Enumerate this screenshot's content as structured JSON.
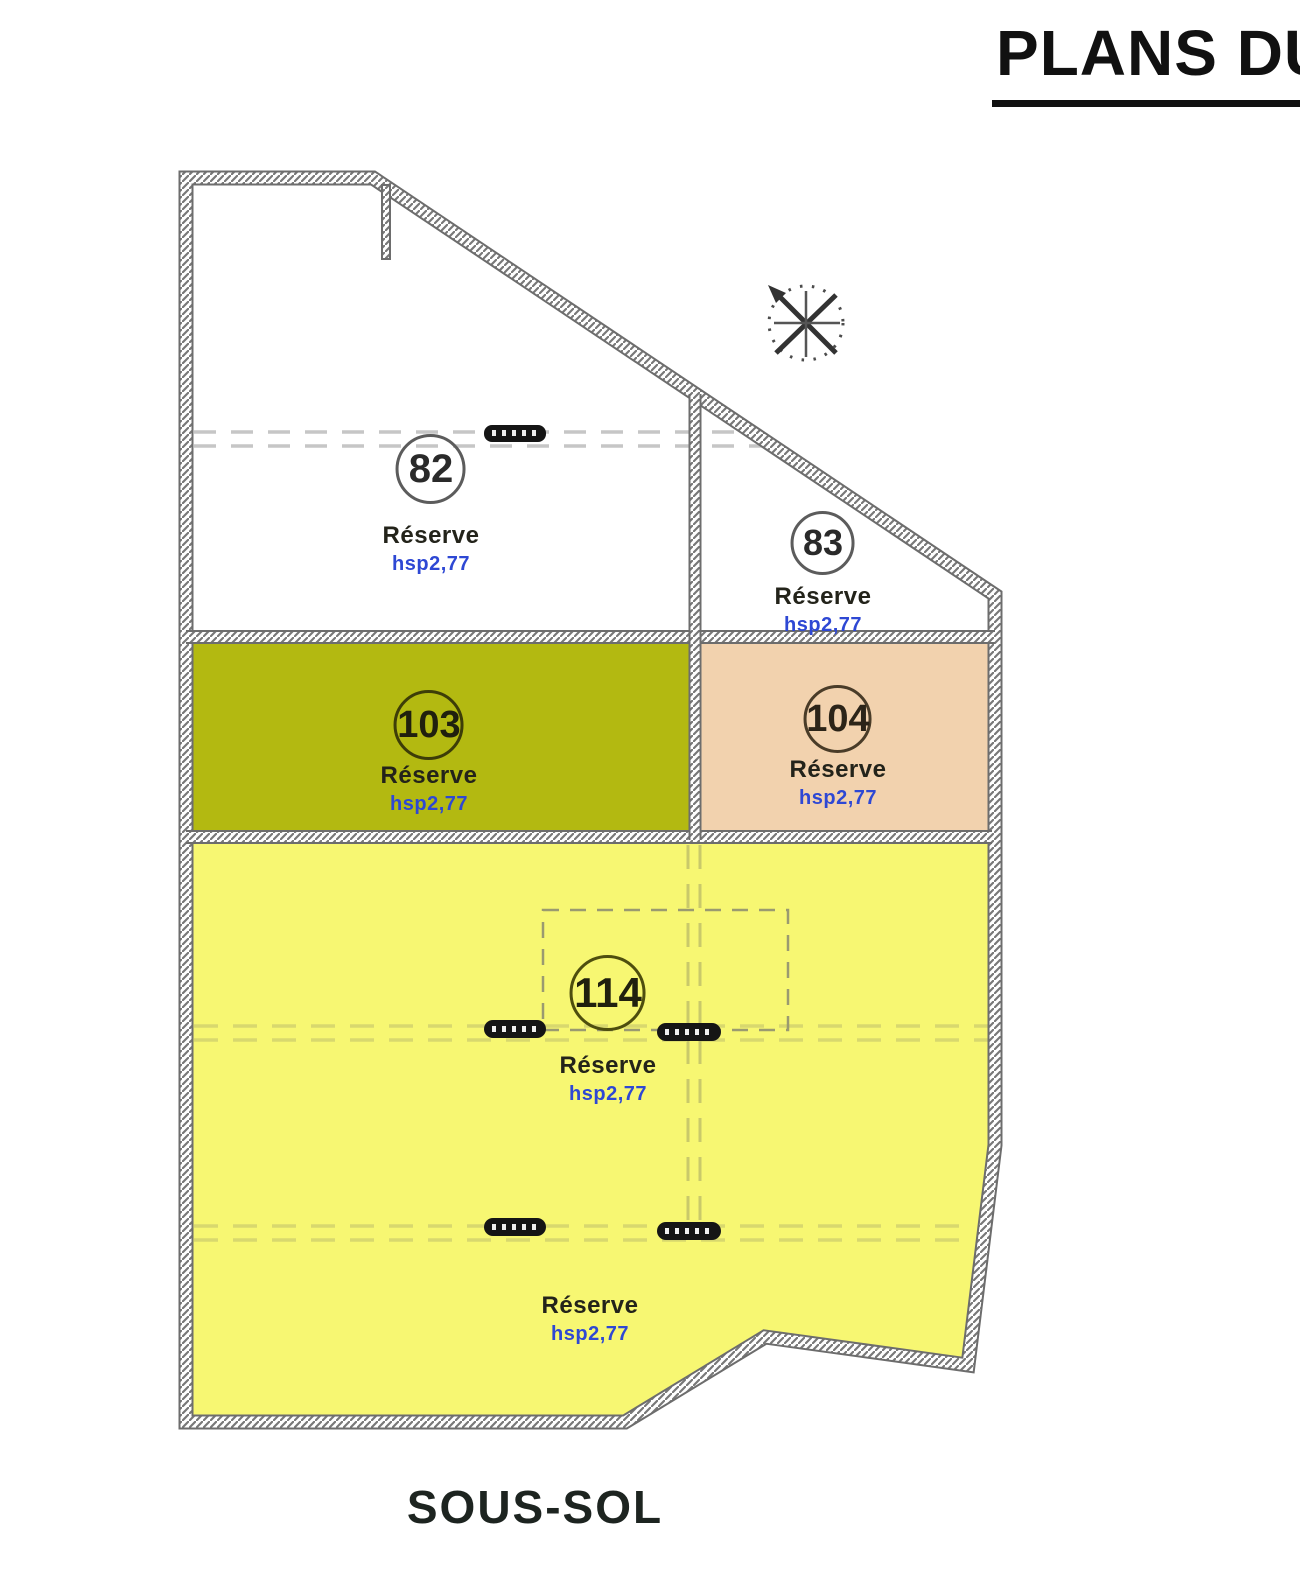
{
  "title": "PLANS DU",
  "footer": "SOUS-SOL",
  "rooms": [
    {
      "number": "82",
      "name": "Réserve",
      "height": "hsp2,77"
    },
    {
      "number": "83",
      "name": "Réserve",
      "height": "hsp2,77"
    },
    {
      "number": "103",
      "name": "Réserve",
      "height": "hsp2,77"
    },
    {
      "number": "104",
      "name": "Réserve",
      "height": "hsp2,77"
    },
    {
      "number": "114",
      "name": "Réserve",
      "height": "hsp2,77"
    },
    {
      "number": "",
      "name": "Réserve",
      "height": "hsp2,77"
    }
  ],
  "colors": {
    "room_103": "#b3b911",
    "room_104": "#f2d2ae",
    "room_114": "#f7f772",
    "wall_hatch": "#777777",
    "dash_gray": "#c6c6c6",
    "dash_yellow": "#d8d86e",
    "hsp_blue": "#2e48d4"
  },
  "icons": [
    "compass-north-icon",
    "beam-symbol"
  ]
}
